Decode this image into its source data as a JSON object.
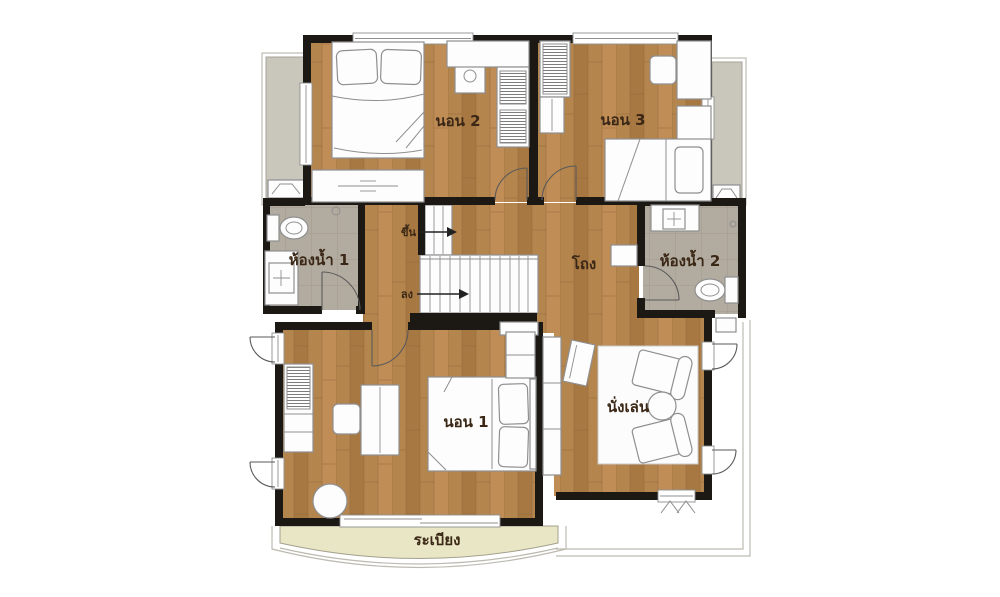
{
  "plan": {
    "rooms": {
      "bedroom2": {
        "label": "นอน 2"
      },
      "bedroom3": {
        "label": "นอน 3"
      },
      "bedroom1": {
        "label": "นอน 1"
      },
      "bathroom1": {
        "label": "ห้องน้ำ 1"
      },
      "bathroom2": {
        "label": "ห้องน้ำ 2"
      },
      "hall": {
        "label": "โถง"
      },
      "sitting": {
        "label": "นั่งเล่น"
      },
      "balcony": {
        "label": "ระเบียง"
      }
    },
    "stairs": {
      "up_label": "ขึ้น",
      "down_label": "ลง"
    }
  },
  "colors": {
    "background": "#ffffff",
    "wall": "#1c1814",
    "wood": "#b5854e",
    "wood_light": "#c08d56",
    "wood_dark": "#a87842",
    "wood_line": "#8a6134",
    "tile": "#b2aba0",
    "tile_line": "#a19988",
    "balcony": "#e9e6c6",
    "side_balcony": "#c9c6bb",
    "furniture_fill": "#fdfdfd",
    "furniture_stroke": "#8f8f8f",
    "label": "#3a2715"
  }
}
